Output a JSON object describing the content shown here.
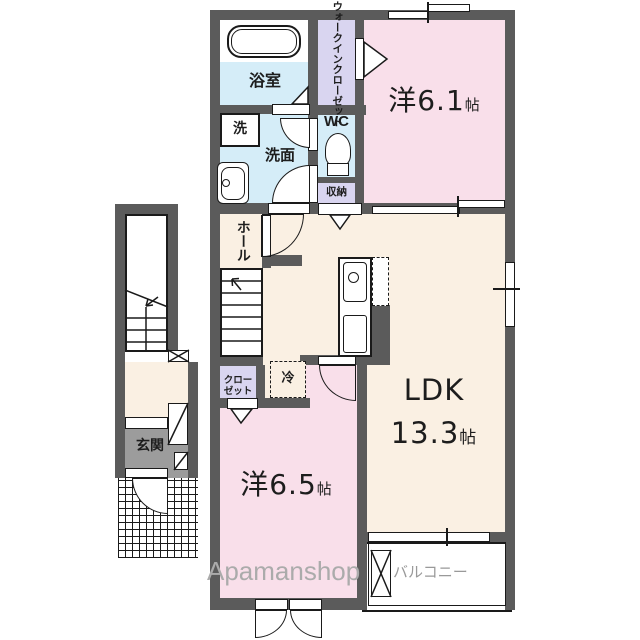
{
  "watermark": {
    "brand": "Apamanshop"
  },
  "labels": {
    "bath": "浴室",
    "washer": "洗",
    "washroom": "洗面",
    "wc": "WC",
    "storage": "収納",
    "wic_col1": "ウォークイン",
    "wic_col2": "クローゼット",
    "hall": "ホール",
    "closet_line1": "クロー",
    "closet_line2": "ゼット",
    "fridge": "冷",
    "entrance": "玄関",
    "balcony": "バルコニー",
    "room61_name": "洋",
    "room61_size": "6.1",
    "room61_unit": "帖",
    "room65_name": "洋",
    "room65_size": "6.5",
    "room65_unit": "帖",
    "ldk_name": "LDK",
    "ldk_size": "13.3",
    "ldk_unit": "帖"
  },
  "colors": {
    "wall": "#5B5B5B",
    "ldk_floor": "#FAF0E3",
    "bedroom_floor": "#F9DFEA",
    "wet_area": "#D5EDF8",
    "closet_area": "#D9D5F0",
    "entrance_floor": "#9C9C9C",
    "watermark_gray": "#ABABAB",
    "balcony_label_gray": "#999999"
  }
}
